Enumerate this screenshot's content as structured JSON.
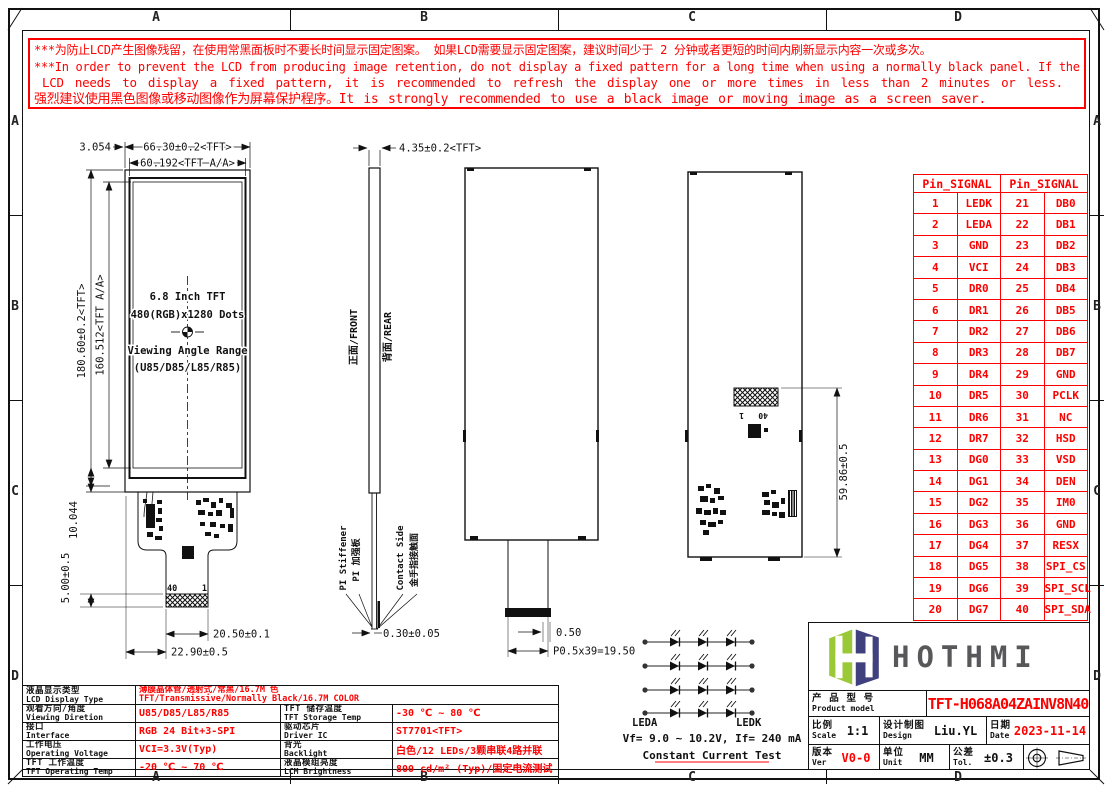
{
  "colors": {
    "red": "#ff0000",
    "ink": "#111111",
    "logo_green": "#9bc837",
    "logo_navy": "#40407e",
    "logo_gray": "#58585b"
  },
  "frame": {
    "cols": [
      "A",
      "B",
      "C",
      "D"
    ],
    "rows": [
      "A",
      "B",
      "C",
      "D"
    ]
  },
  "warning": {
    "l1": "***为防止LCD产生图像残留，在使用常黑面板时不要长时间显示固定图案。 如果LCD需要显示固定图案，建议时间少于 2 分钟或者更短的时间内刷新显示内容一次或多次。",
    "l2": "***In order to prevent the LCD from producing image retention, do not display a fixed pattern for a long time when using a normally black panel. If the",
    "l3": "LCD needs to display a fixed pattern, it is recommended to refresh the display one or more times in less than 2 minutes or less.",
    "l4": "强烈建议使用黑色图像或移动图像作为屏幕保护程序。It is strongly recommended to use a black image or moving image as a screen saver."
  },
  "front": {
    "w1": "66.30±0.2<TFT>",
    "w2": "60.192<TFT A/A>",
    "border": "3.054",
    "h1": "180.60±0.2<TFT>",
    "h2": "160.512<TFT A/A>",
    "ledge": "10.044",
    "conn": "5.00±0.5",
    "tail": "20.50±0.1",
    "off": "22.90±0.5",
    "pin40": "40",
    "pin1": "1",
    "t1": "6.8 Inch TFT",
    "t2": "480(RGB)x1280 Dots",
    "t3": "Viewing Angle Range",
    "t4": "(U85/D85/L85/R85)"
  },
  "side": {
    "t": "4.35±0.2<TFT>",
    "front": "正面/FRONT",
    "rear": "背面/REAR",
    "pi1": "PI Stiffener",
    "pi2": "PI 加强板",
    "cs1": "Contact Side",
    "cs2": "金手指接触面",
    "ft": "0.30±0.05"
  },
  "rear": {
    "t": "0.50",
    "pitch": "P0.5x39=19.50",
    "h": "59.86±0.5",
    "pin1": "1",
    "pin40": "40"
  },
  "led": {
    "a": "LEDA",
    "k": "LEDK",
    "vf": "Vf= 9.0 ~ 10.2V, If= 240 mA",
    "note": "Constant Current Test"
  },
  "pin_table": {
    "h1": "Pin_SIGNAL",
    "h2": "Pin_SIGNAL",
    "rows": [
      [
        "1",
        "LEDK",
        "21",
        "DB0"
      ],
      [
        "2",
        "LEDA",
        "22",
        "DB1"
      ],
      [
        "3",
        "GND",
        "23",
        "DB2"
      ],
      [
        "4",
        "VCI",
        "24",
        "DB3"
      ],
      [
        "5",
        "DR0",
        "25",
        "DB4"
      ],
      [
        "6",
        "DR1",
        "26",
        "DB5"
      ],
      [
        "7",
        "DR2",
        "27",
        "DB6"
      ],
      [
        "8",
        "DR3",
        "28",
        "DB7"
      ],
      [
        "9",
        "DR4",
        "29",
        "GND"
      ],
      [
        "10",
        "DR5",
        "30",
        "PCLK"
      ],
      [
        "11",
        "DR6",
        "31",
        "NC"
      ],
      [
        "12",
        "DR7",
        "32",
        "HSD"
      ],
      [
        "13",
        "DG0",
        "33",
        "VSD"
      ],
      [
        "14",
        "DG1",
        "34",
        "DEN"
      ],
      [
        "15",
        "DG2",
        "35",
        "IM0"
      ],
      [
        "16",
        "DG3",
        "36",
        "GND"
      ],
      [
        "17",
        "DG4",
        "37",
        "RESX"
      ],
      [
        "18",
        "DG5",
        "38",
        "SPI_CS"
      ],
      [
        "19",
        "DG6",
        "39",
        "SPI_SCL"
      ],
      [
        "20",
        "DG7",
        "40",
        "SPI_SDA"
      ]
    ]
  },
  "spec": {
    "rows": [
      {
        "zh": "液晶显示类型",
        "en": "LCD Display Type",
        "v1zh": "薄膜晶体管/透射式/常黑/16.7M 色",
        "v1en": "TFT/Transmissive/Normally Black/16.7M COLOR"
      },
      {
        "zh": "观看方向/角度",
        "en": "Viewing Diretion",
        "v1": "U85/D85/L85/R85",
        "zh2": "TFT 储存温度",
        "en2": "TFT Storage Temp",
        "v2": "-30 ℃ ~ 80 ℃"
      },
      {
        "zh": "接口",
        "en": "Interface",
        "v1": "RGB 24 Bit+3-SPI",
        "zh2": "驱动芯片",
        "en2": "Driver IC",
        "v2": "ST7701<TFT>"
      },
      {
        "zh": "工作电压",
        "en": "Operating Voltage",
        "v1": "VCI=3.3V(Typ)",
        "zh2": "背光",
        "en2": "Backlight",
        "v2": "白色/12 LEDs/3颗串联4路并联"
      },
      {
        "zh": "TFT 工作温度",
        "en": "TFT Operating Temp",
        "v1": "-20 ℃ ~ 70 ℃",
        "zh2": "液晶模组亮度",
        "en2": "LCM Brightness",
        "v2": "800 cd/m² (Typ)/固定电流测试"
      }
    ]
  },
  "title_block": {
    "logo": "HOTHMI",
    "product_zh": "产 品 型 号",
    "product_en": "Product model",
    "model": "TFT-H068A04ZAINV8N40",
    "scale_zh": "比例",
    "scale_en": "Scale",
    "scale": "1:1",
    "design_zh": "设计制图",
    "design_en": "Design",
    "design": "Liu.YL",
    "date_zh": "日期",
    "date_en": "Date",
    "date": "2023-11-14",
    "ver_zh": "版本",
    "ver_en": "Ver",
    "ver": "V0-0",
    "unit_zh": "单位",
    "unit_en": "Unit",
    "unit": "MM",
    "tol_zh": "公差",
    "tol_en": "Tol.",
    "tol": "±0.3"
  }
}
